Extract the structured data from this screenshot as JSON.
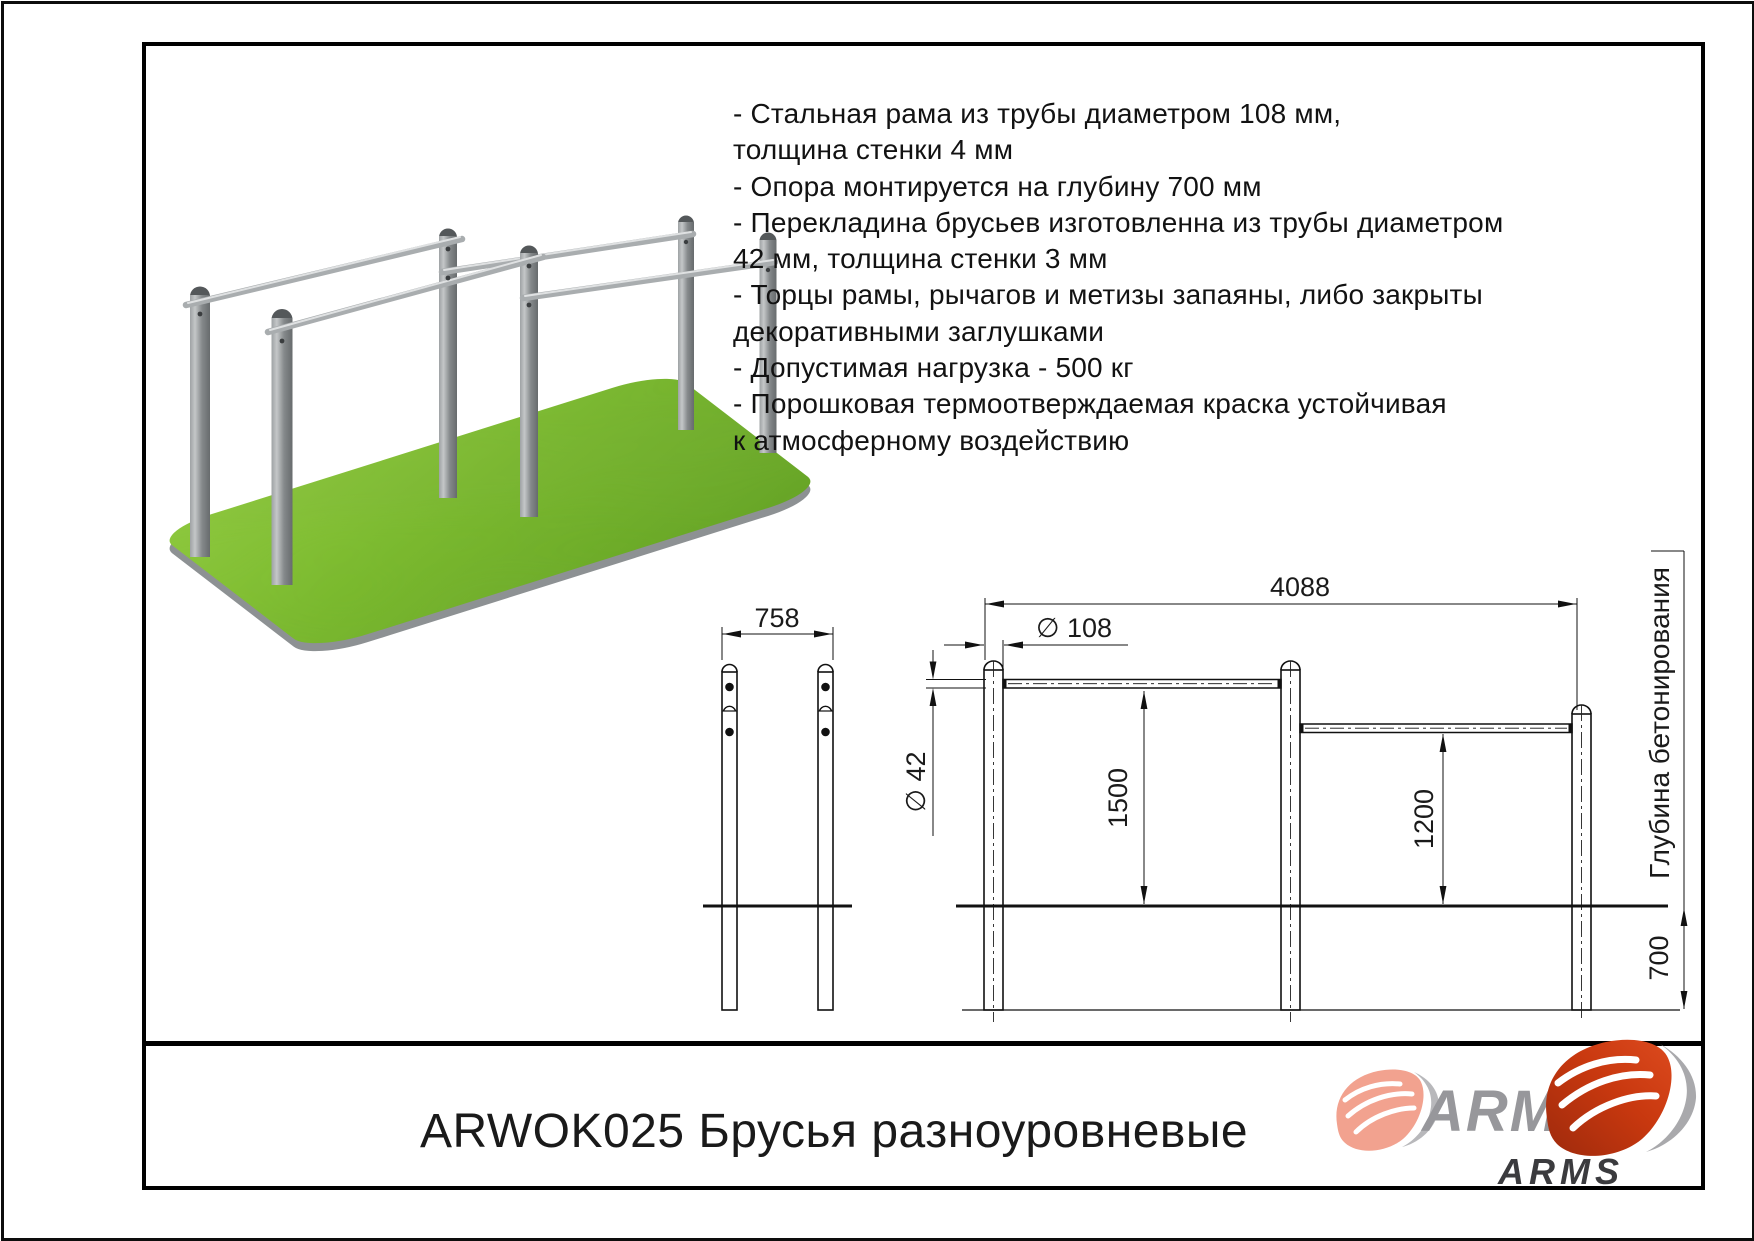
{
  "document": {
    "product_title": "ARWOK025 Брусья разноуровневые"
  },
  "specs": {
    "lines": [
      "- Стальная рама из трубы диаметром 108 мм,",
      "толщина стенки 4 мм",
      "- Опора монтируется на глубину 700 мм",
      "- Перекладина брусьев изготовленна из трубы диаметром",
      "42 мм, толщина стенки 3 мм",
      "- Торцы рамы, рычагов и метизы запаяны, либо закрыты",
      "декоративными заглушками",
      "- Допустимая нагрузка - 500 кг",
      "- Порошковая термоотверждаемая краска устойчивая",
      "к атмосферному воздействию"
    ]
  },
  "front_view": {
    "width_dim": "758"
  },
  "side_view": {
    "length_dim": "4088",
    "post_diameter_dim": "∅ 108",
    "bar_diameter_dim": "∅ 42",
    "left_height_dim": "1500",
    "right_height_dim": "1200",
    "foundation_depth_dim": "700",
    "foundation_label": "Глубина бетонирования"
  },
  "logo": {
    "brand": "ARMS",
    "brand_sub": "ARMS"
  },
  "colors": {
    "grass_green": "#76b82a",
    "steel_gray": "#8d9193",
    "drawing_line": "#111111",
    "arms_red": "#c8380f",
    "arms_pink": "#f2a28f",
    "arms_gray": "#97979b",
    "arms_dark": "#3b3b3e"
  }
}
